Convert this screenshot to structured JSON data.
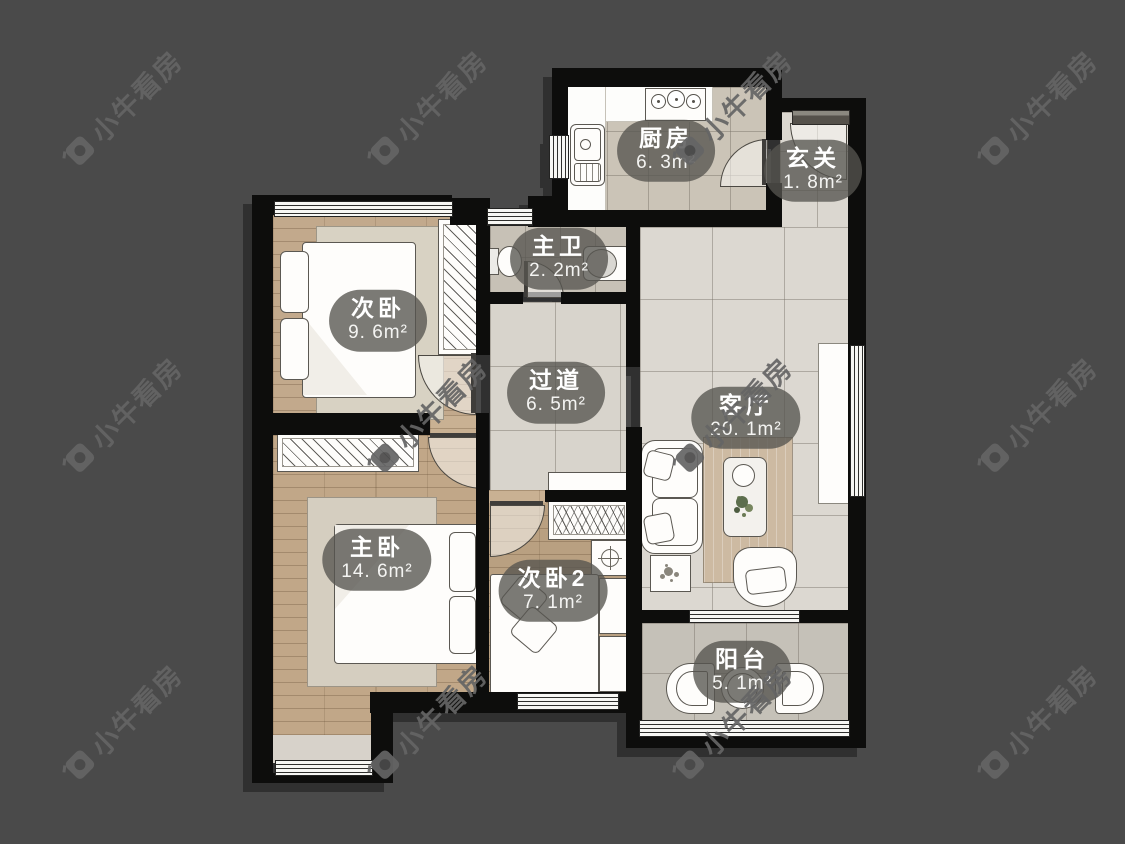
{
  "watermark": {
    "text": "小牛看房"
  },
  "rooms": [
    {
      "key": "kitchen",
      "name": "厨房",
      "area": "6. 3m²"
    },
    {
      "key": "entry",
      "name": "玄关",
      "area": "1. 8m²"
    },
    {
      "key": "master-bath",
      "name": "主卫",
      "area": "2. 2m²"
    },
    {
      "key": "bedroom-2",
      "name": "次卧",
      "area": "9. 6m²"
    },
    {
      "key": "hallway",
      "name": "过道",
      "area": "6. 5m²"
    },
    {
      "key": "living-room",
      "name": "客厅",
      "area": "20. 1m²"
    },
    {
      "key": "master-bedroom",
      "name": "主卧",
      "area": "14. 6m²"
    },
    {
      "key": "bedroom-3",
      "name": "次卧2",
      "area": "7. 1m²"
    },
    {
      "key": "balcony",
      "name": "阳台",
      "area": "5. 1m²"
    }
  ],
  "colors": {
    "background": "#4a4a4a",
    "wall": "#0d0d0c",
    "wood_floor": "#c1a88a",
    "tile_floor": "#dbd7d0",
    "kitchen_floor": "#cbc4b7",
    "bath_floor": "#c7c1b6",
    "balcony_floor": "#c5c1b8",
    "label_bubble": "rgba(86,84,79,0.78)",
    "watermark": "#656565"
  }
}
